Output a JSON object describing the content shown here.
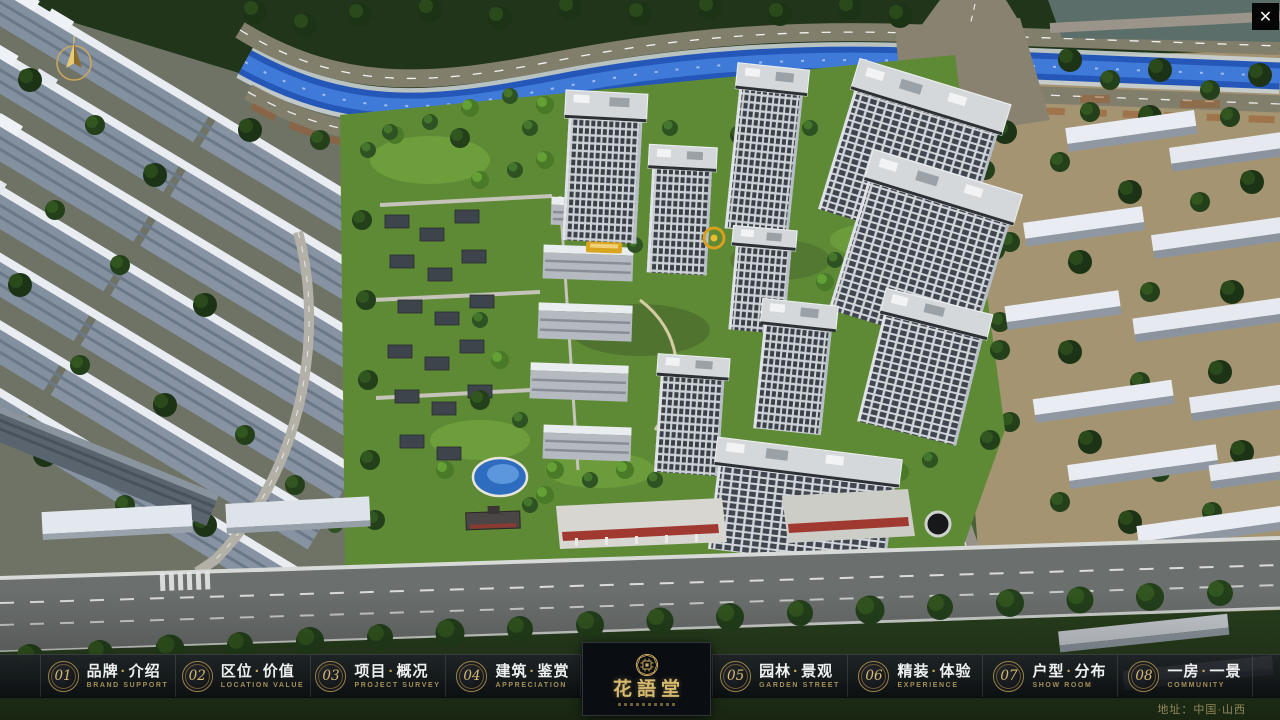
{
  "app": {
    "close_icon": "✕"
  },
  "logo": {
    "title": "花語堂"
  },
  "map": {
    "location_label": "地址：中国·山西"
  },
  "menu": {
    "separator": "·",
    "items": [
      {
        "number": "01",
        "zh_left": "品牌",
        "zh_right": "介绍",
        "en": "BRAND SUPPORT"
      },
      {
        "number": "02",
        "zh_left": "区位",
        "zh_right": "价值",
        "en": "LOCATION VALUE"
      },
      {
        "number": "03",
        "zh_left": "项目",
        "zh_right": "概况",
        "en": "PROJECT SURVEY"
      },
      {
        "number": "04",
        "zh_left": "建筑",
        "zh_right": "鉴赏",
        "en": "APPRECIATION"
      },
      {
        "number": "05",
        "zh_left": "园林",
        "zh_right": "景观",
        "en": "GARDEN STREET"
      },
      {
        "number": "06",
        "zh_left": "精装",
        "zh_right": "体验",
        "en": "EXPERIENCE"
      },
      {
        "number": "07",
        "zh_left": "户型",
        "zh_right": "分布",
        "en": "SHOW ROOM"
      },
      {
        "number": "08",
        "zh_left": "一房",
        "zh_right": "一景",
        "en": "COMMUNITY"
      }
    ]
  },
  "colors": {
    "gold": "#c9a75a",
    "river": "#2a5fc4",
    "bar_bg": "#12161a"
  }
}
